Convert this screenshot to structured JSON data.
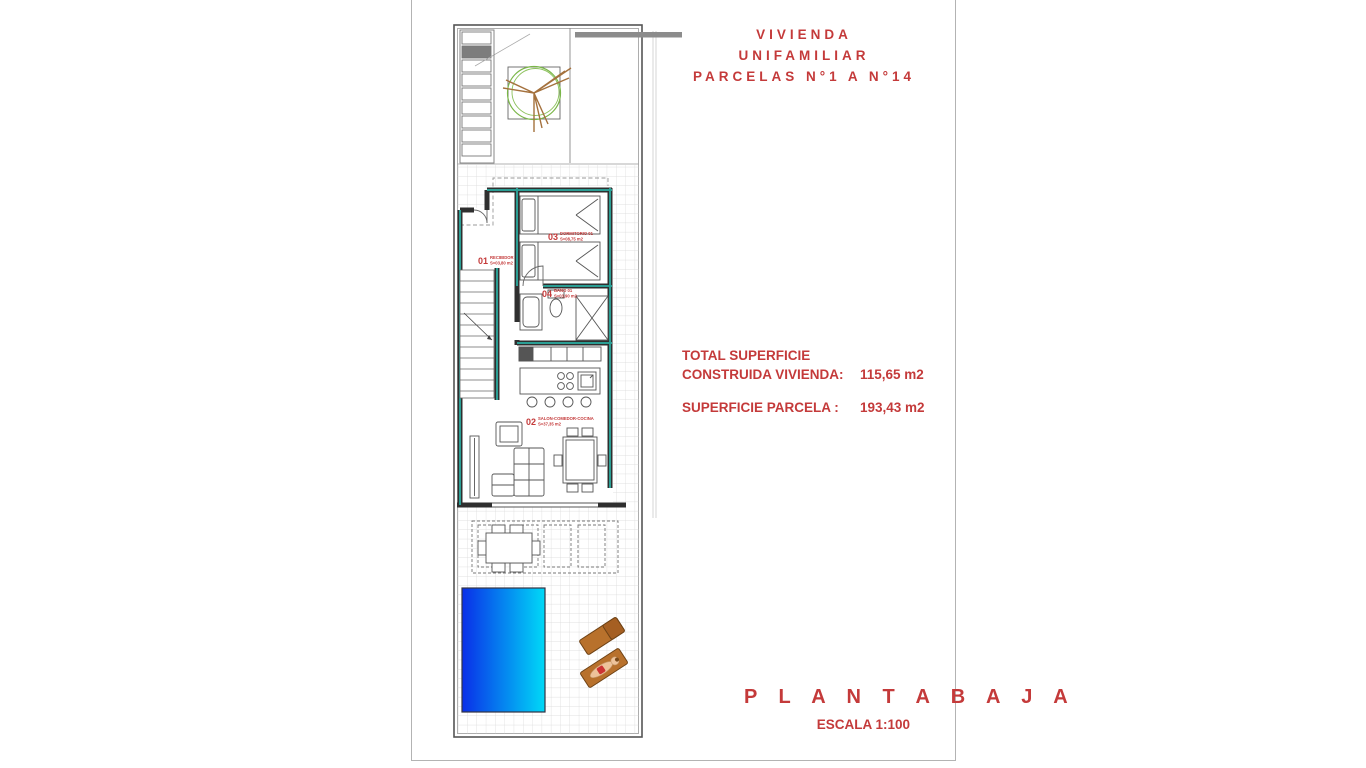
{
  "header": {
    "title_line1": "VIVIENDA UNIFAMILIAR",
    "title_line2": "PARCELAS N°1 A N°14"
  },
  "areas": {
    "total_label_line1": "TOTAL SUPERFICIE",
    "total_label_line2": "CONSTRUIDA VIVIENDA:",
    "total_value": "115,65 m2",
    "parcel_label": "SUPERFICIE PARCELA :",
    "parcel_value": "193,43 m2"
  },
  "footer": {
    "plan_name": "P L A N T A   B A J A",
    "scale": "ESCALA 1:100"
  },
  "plan": {
    "rooms": [
      {
        "number": "01",
        "name": "RECIBIDOR",
        "area": "S=03,80 m2"
      },
      {
        "number": "02",
        "name": "SALON-COMEDOR-COCINA",
        "area": "S=37,35 m2"
      },
      {
        "number": "03",
        "name": "DORMITORIO 01",
        "area": "S=08,75 m2"
      },
      {
        "number": "04",
        "name": "BAÑO 01",
        "area": "S=03,90 m2"
      }
    ],
    "icons": {
      "tree": "tree-icon",
      "pool": "pool",
      "sun_loungers": "sun-lounger-icon",
      "beds": "bed-icon",
      "shower": "shower-icon",
      "stairs": "stairs-icon",
      "sofa": "sofa-icon",
      "dining_table": "dining-table-icon",
      "kitchen_island": "kitchen-island-icon"
    },
    "colors": {
      "accent_red": "#c43a3a",
      "wall_dark": "#2f2f2f",
      "wall_teal": "#2b9e94",
      "pool_start": "#0a2fe8",
      "pool_end": "#00d9f7",
      "lounger_brown": "#b8712c",
      "tree_green": "#7ab648"
    }
  }
}
